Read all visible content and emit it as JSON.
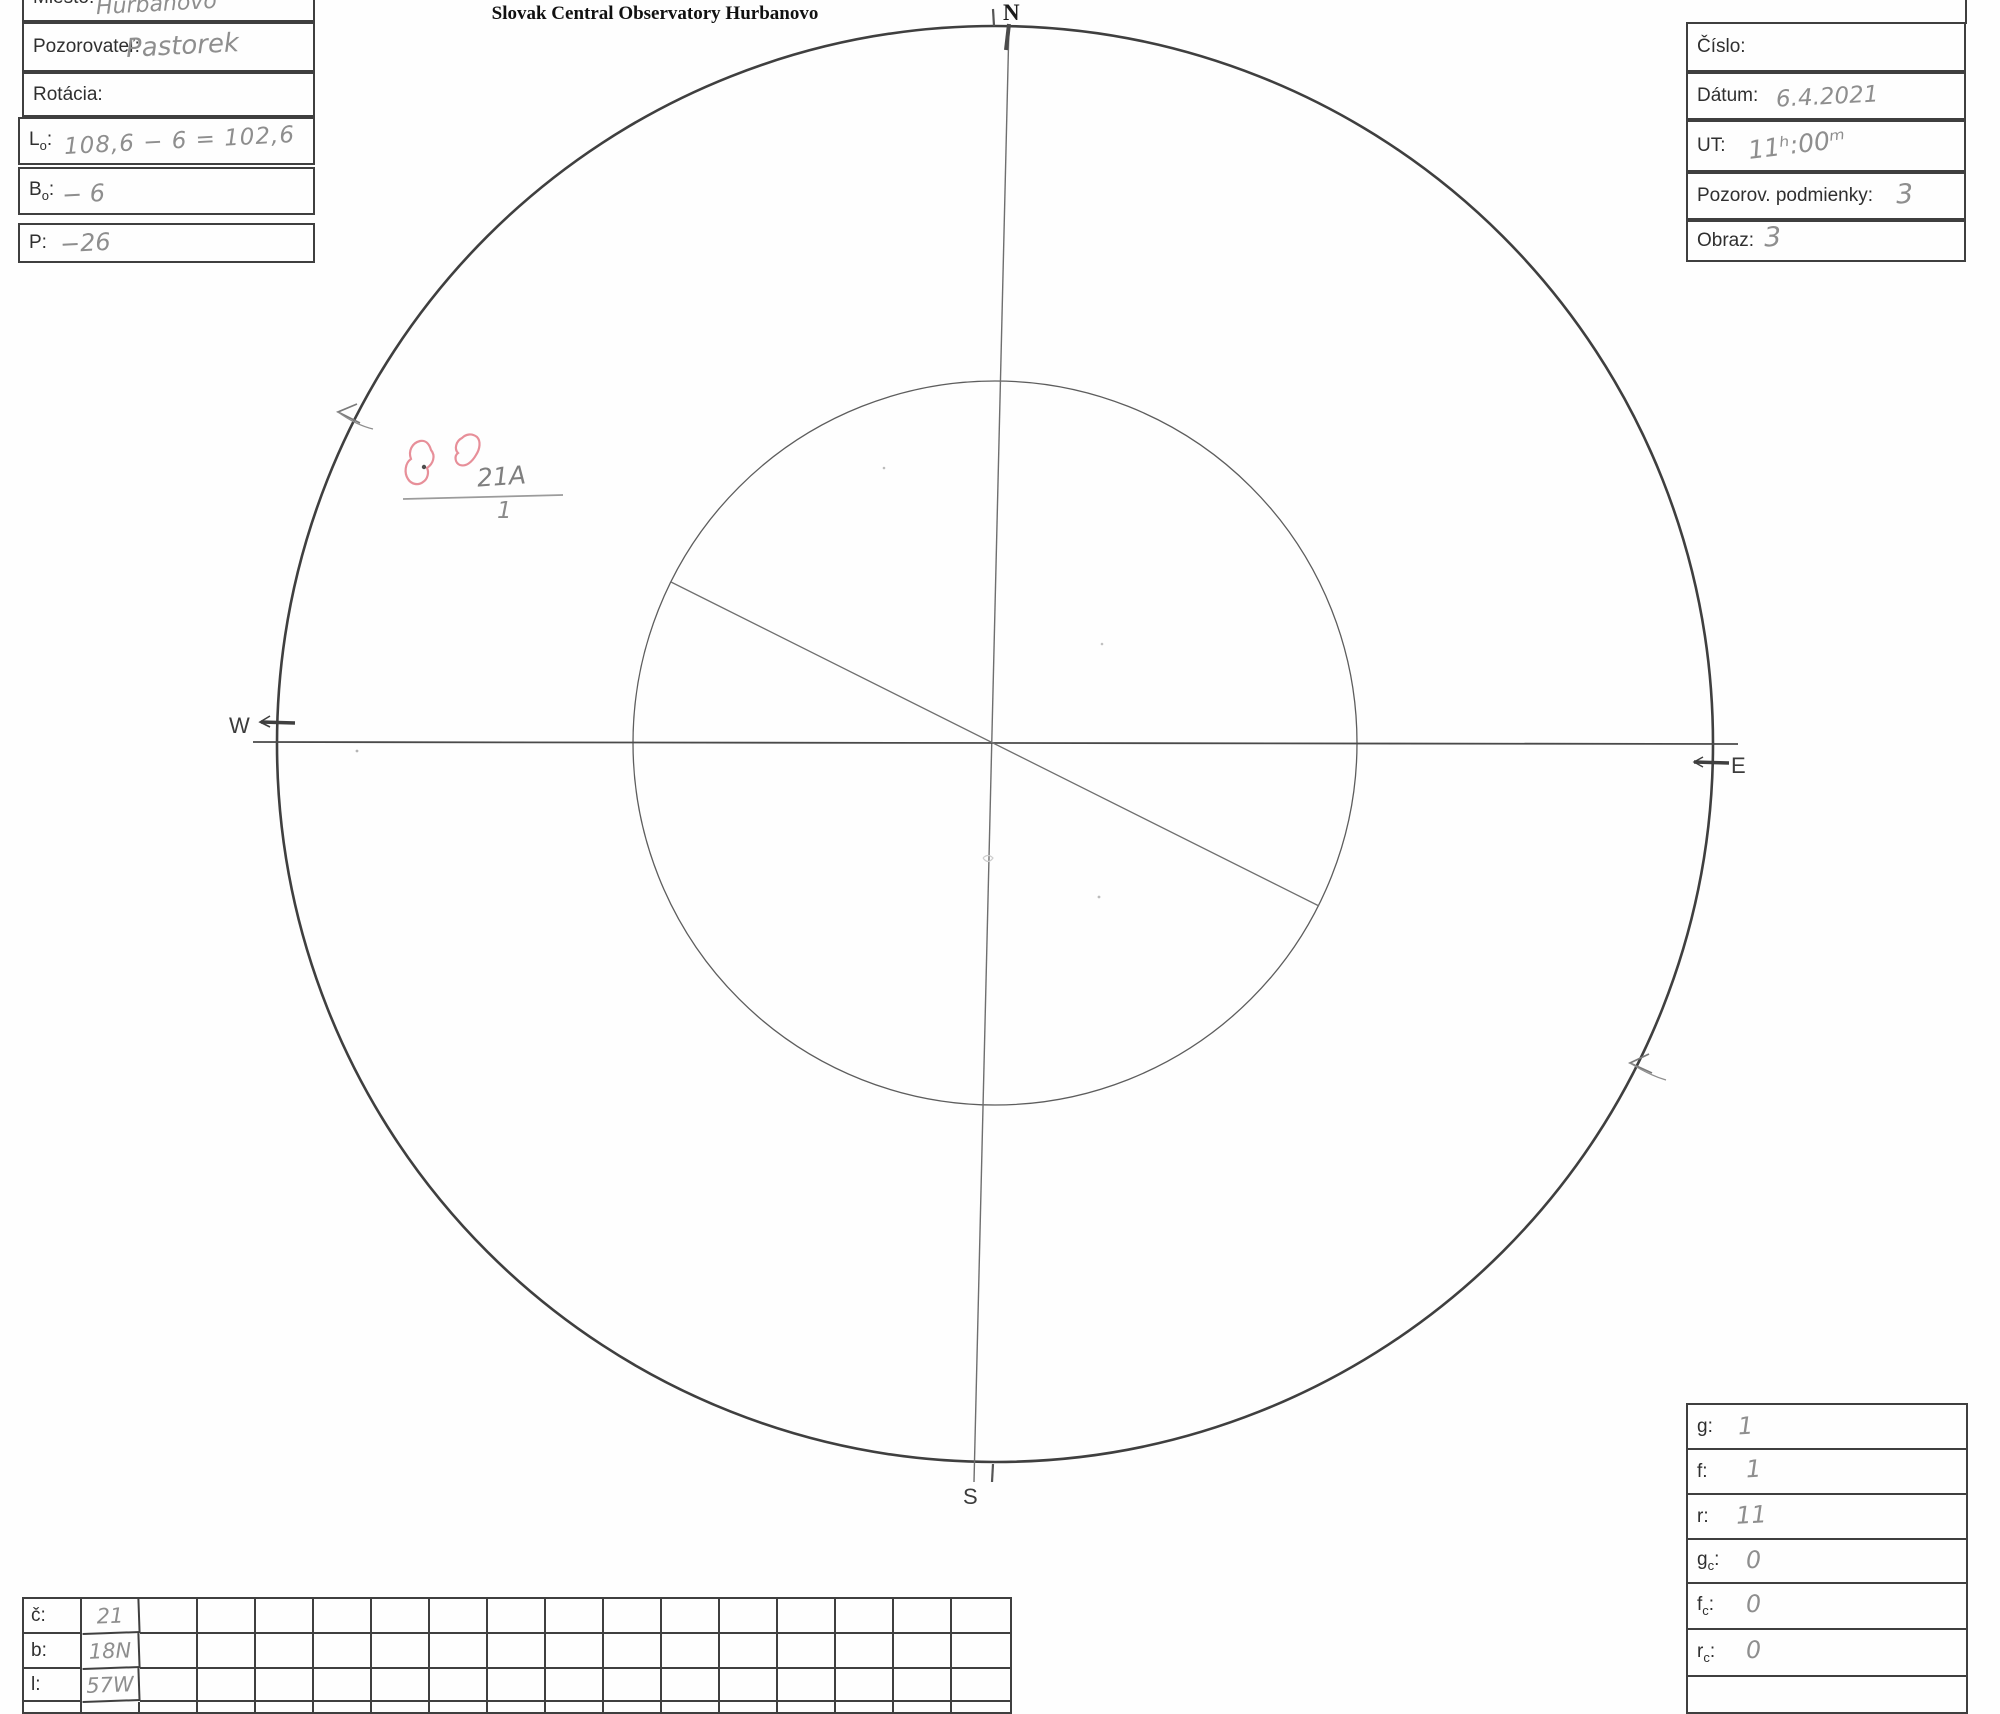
{
  "title": "Slovak Central Observatory Hurbanovo",
  "misc": {
    "colon": ":"
  },
  "compass": {
    "n": "N",
    "s": "S",
    "e": "E",
    "w": "W"
  },
  "left_form": {
    "miesto_label": "Miesto:",
    "miesto_value": "Hurbanovo",
    "pozorovatel_label": "Pozorovateľ:",
    "pozorovatel_value": "Pastorek",
    "rotacia_label": "Rotácia:",
    "rotacia_value": "",
    "l0_label_main": "L",
    "l0_label_sub": "o",
    "l0_value": "108,6 − 6 = 102,6",
    "b0_label_main": "B",
    "b0_label_sub": "o",
    "b0_value": "− 6",
    "p_label": "P:",
    "p_value": "−26"
  },
  "right_form": {
    "cislo_label": "Číslo:",
    "cislo_value": "",
    "datum_label": "Dátum:",
    "datum_value": "6.4.2021",
    "ut_label": "UT:",
    "ut_value": "11ʰ:00ᵐ",
    "podmienky_label": "Pozorov. podmienky:",
    "podmienky_value": "3",
    "obraz_label": "Obraz:",
    "obraz_value": "3"
  },
  "counts_form": {
    "g_label": "g:",
    "g_value": "1",
    "f_label": "f:",
    "f_value": "1",
    "r_label": "r:",
    "r_value": "11",
    "gc_label_main": "g",
    "gc_label_sub": "c",
    "gc_value": "0",
    "fc_label_main": "f",
    "fc_label_sub": "c",
    "fc_value": "0",
    "rc_label_main": "r",
    "rc_label_sub": "c",
    "rc_value": "0"
  },
  "position_table": {
    "rows": [
      {
        "label": "č:",
        "value": "21"
      },
      {
        "label": "b:",
        "value": "18N"
      },
      {
        "label": "l:",
        "value": "57W"
      }
    ],
    "empty_columns_per_row": 15
  },
  "annotations": {
    "group_designation": "21A",
    "group_count": "1"
  },
  "colors": {
    "pencil": "#8e8e8e",
    "red_sketch": "#e78f99",
    "line_ink": "#3f3f3f"
  }
}
